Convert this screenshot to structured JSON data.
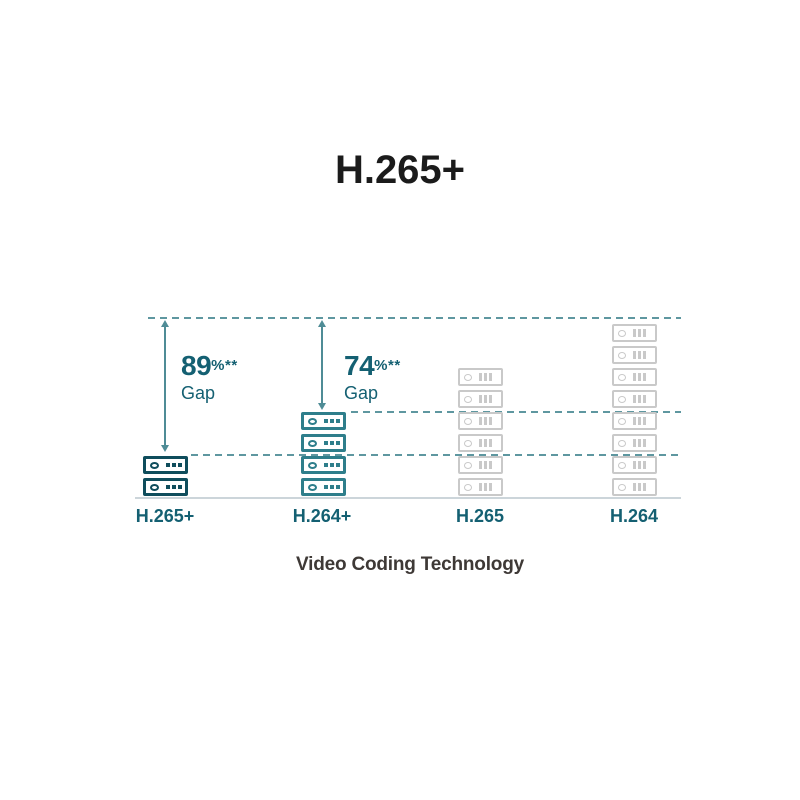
{
  "title": "H.265+",
  "x_axis_label": "Video Coding Technology",
  "colors": {
    "h265plus_stack": "#0f4d5c",
    "h264plus_stack": "#2e7e8b",
    "legacy_stack": "#c9c9c9",
    "dashed_line": "#5e97a0",
    "arrow": "#4f8c96",
    "teal_label": "#146072",
    "baseline": "#ccd5da",
    "title_color": "#1b1b1b",
    "x_label_color": "#3e3936"
  },
  "chart_data": {
    "type": "bar",
    "subtype": "pictogram-stacked-server-icons",
    "title": "H.265+",
    "xlabel": "Video Coding Technology",
    "ylabel": "",
    "categories": [
      "H.265+",
      "H.264+",
      "H.265",
      "H.264"
    ],
    "values": [
      2,
      4,
      6,
      8
    ],
    "value_unit": "server icons (relative storage consumption)",
    "bar_colors": [
      "#0f4d5c",
      "#2e7e8b",
      "#c9c9c9",
      "#c9c9c9"
    ],
    "icon_styles": [
      "dots",
      "dots",
      "bars",
      "bars"
    ],
    "grid": "dashed horizontal reference lines at tops of H.264, H.264+ and H.265+ stacks",
    "legend_position": "none",
    "annotations": [
      {
        "category": "H.265+",
        "value": "89",
        "suffix": "%**",
        "label": "Gap",
        "meaning": "gap between H.265+ stack top and H.264 reference line"
      },
      {
        "category": "H.264+",
        "value": "74",
        "suffix": "%**",
        "label": "Gap",
        "meaning": "gap between H.264+ stack top and H.264 reference line"
      }
    ]
  }
}
